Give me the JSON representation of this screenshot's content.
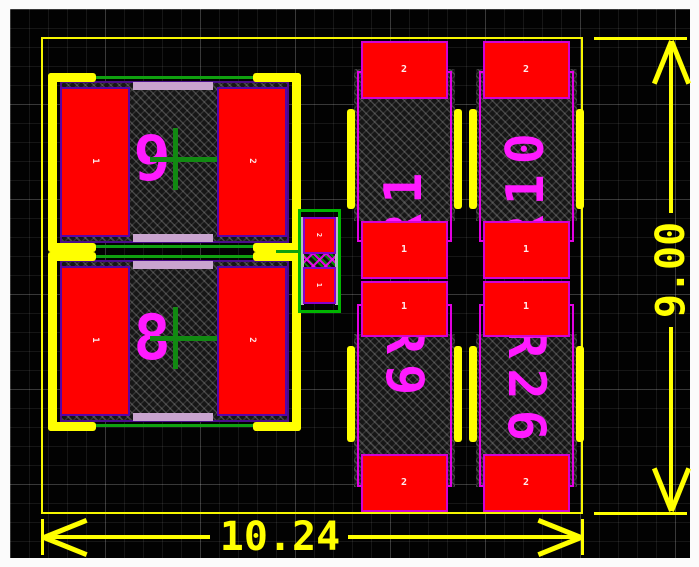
{
  "view": {
    "type": "pcb-footprint-layout",
    "background": "#000000"
  },
  "dimensions": {
    "horizontal": {
      "value": "10.24"
    },
    "vertical": {
      "value": "9.00"
    }
  },
  "components": {
    "cap_top": {
      "ref": "9",
      "pad_left": "1",
      "pad_right": "2"
    },
    "cap_bottom": {
      "ref": "8",
      "pad_left": "1",
      "pad_right": "2"
    },
    "small": {
      "pad_top": "2",
      "pad_bottom": "1"
    },
    "res_top_left": {
      "ref": "R1",
      "pad_top": "2",
      "pad_bottom": "1"
    },
    "res_top_right": {
      "ref": "R10",
      "pad_top": "2",
      "pad_bottom": "1"
    },
    "res_bot_left": {
      "ref": "R9",
      "pad_top": "1",
      "pad_bottom": "2"
    },
    "res_bot_right": {
      "ref": "R26",
      "pad_top": "1",
      "pad_bottom": "2"
    }
  },
  "colors": {
    "pad_copper": "#ff0000",
    "pad_outline_dark": "#5804a8",
    "pad_outline_magenta": "#d400d4",
    "silkscreen": "#ffff00",
    "designator": "#ff1aff",
    "assembly_green": "#0fa00f",
    "courtyard_magenta": "#e100e1",
    "paste_bar_lavender": "#c9a4cf",
    "body_hatch": "#555555",
    "grid": "#3a3a3a",
    "background": "#000000"
  }
}
